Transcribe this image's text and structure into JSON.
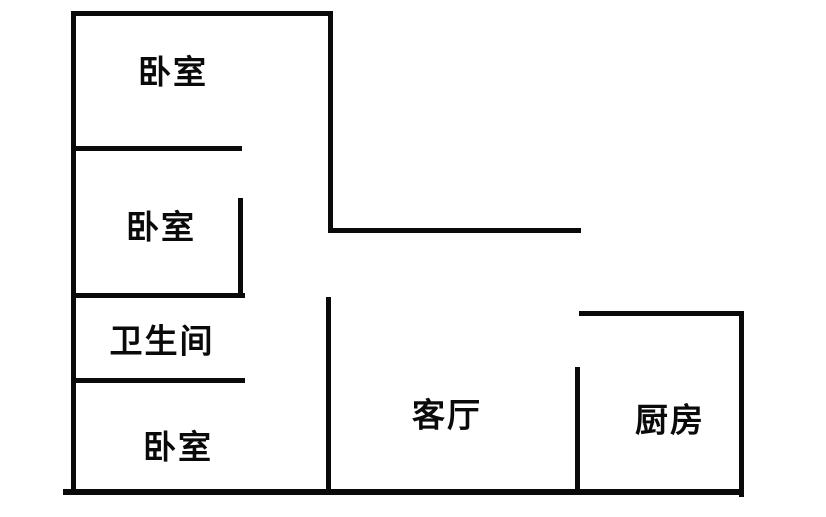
{
  "diagram": {
    "type": "floor-plan",
    "background_color": "#ffffff",
    "wall_color": "#0a0a0a",
    "text_color": "#0a0a0a",
    "rooms": [
      {
        "id": "bedroom-top",
        "label": "卧室"
      },
      {
        "id": "bedroom-middle",
        "label": "卧室"
      },
      {
        "id": "bathroom",
        "label": "卫生间"
      },
      {
        "id": "bedroom-bottom",
        "label": "卧室"
      },
      {
        "id": "living-room",
        "label": "客厅"
      },
      {
        "id": "kitchen",
        "label": "厨房"
      }
    ],
    "walls": [
      {
        "name": "top-wall",
        "x": 71,
        "y": 11,
        "w": 262,
        "h": 5
      },
      {
        "name": "left-wall",
        "x": 71,
        "y": 11,
        "w": 5,
        "h": 483
      },
      {
        "name": "hall-right-wall",
        "x": 328,
        "y": 11,
        "w": 5,
        "h": 222
      },
      {
        "name": "hall-bottom-line",
        "x": 328,
        "y": 228,
        "w": 253,
        "h": 5
      },
      {
        "name": "bedroom-top-divider",
        "x": 71,
        "y": 146,
        "w": 171,
        "h": 5
      },
      {
        "name": "bedroom-middle-right-wall",
        "x": 238,
        "y": 198,
        "w": 5,
        "h": 100
      },
      {
        "name": "bedroom-middle-divider",
        "x": 71,
        "y": 293,
        "w": 174,
        "h": 5
      },
      {
        "name": "bathroom-divider",
        "x": 71,
        "y": 378,
        "w": 174,
        "h": 5
      },
      {
        "name": "living-room-left-wall",
        "x": 326,
        "y": 297,
        "w": 5,
        "h": 197
      },
      {
        "name": "bottom-wall",
        "x": 63,
        "y": 489,
        "w": 680,
        "h": 6
      },
      {
        "name": "kitchen-top-wall",
        "x": 579,
        "y": 311,
        "w": 165,
        "h": 5
      },
      {
        "name": "kitchen-right-wall",
        "x": 739,
        "y": 311,
        "w": 5,
        "h": 186
      },
      {
        "name": "kitchen-left-wall",
        "x": 575,
        "y": 367,
        "w": 5,
        "h": 123
      }
    ]
  }
}
